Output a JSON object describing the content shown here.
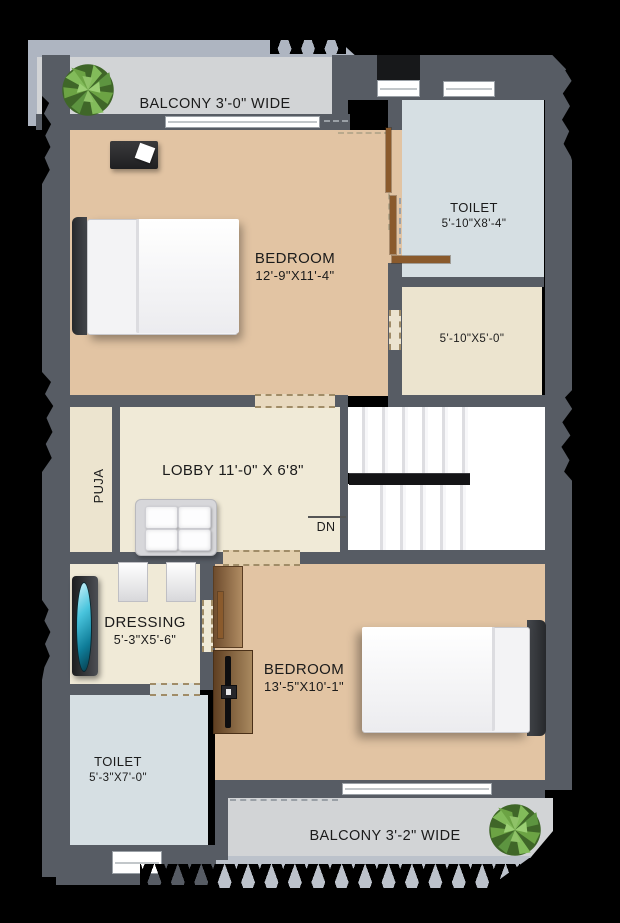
{
  "plan": {
    "balcony_top": {
      "label": "BALCONY 3'-0\" WIDE"
    },
    "bedroom_top": {
      "name": "BEDROOM",
      "dims": "12'-9\"X11'-4\""
    },
    "toilet_top": {
      "name": "TOILET",
      "dims": "5'-10\"X8'-4\""
    },
    "store": {
      "dims": "5'-10\"X5'-0\""
    },
    "puja": {
      "name": "PUJA"
    },
    "lobby": {
      "name": "LOBBY 11'-0\" X 6'8\""
    },
    "stairs": {
      "down_label": "DN"
    },
    "dressing": {
      "name": "DRESSING",
      "dims": "5'-3\"X5'-6\""
    },
    "toilet_bottom": {
      "name": "TOILET",
      "dims": "5'-3\"X7'-0\""
    },
    "bedroom_bottom": {
      "name": "BEDROOM",
      "dims": "13'-5\"X10'-1\""
    },
    "balcony_bottom": {
      "label": "BALCONY 3'-2\" WIDE"
    }
  },
  "colors": {
    "wall": "#575c64",
    "bedroom_floor": "#e2c4a3",
    "toilet_floor": "#d6dfe3",
    "lobby_floor": "#f0ead7",
    "store_floor": "#ece4cf",
    "balcony_floor": "#d2d4d6",
    "parapet": "#aeb5c1",
    "door_wood": "#8a5a2c",
    "plant_green": "#5d9440",
    "mirror_teal": "#27b9d8"
  }
}
